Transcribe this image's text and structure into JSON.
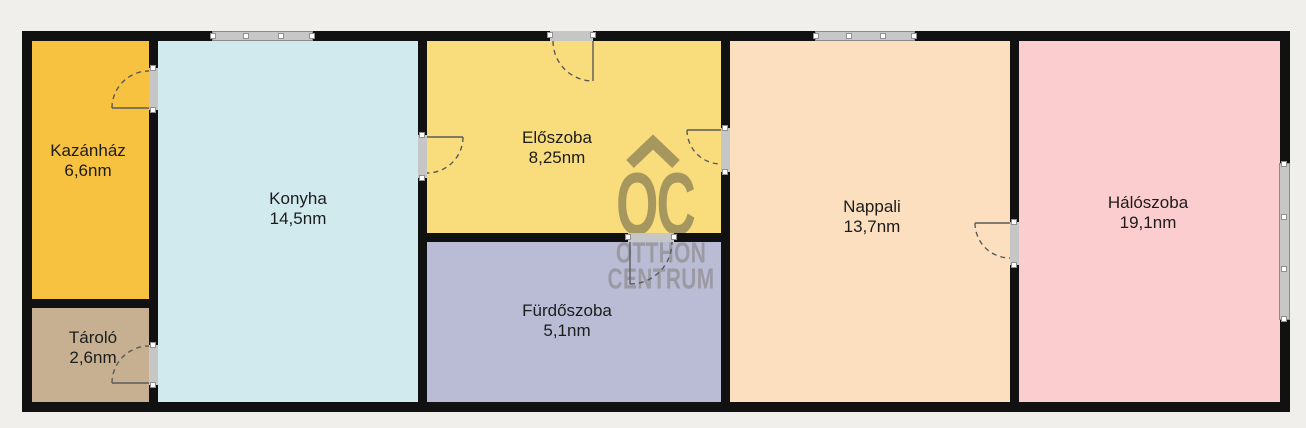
{
  "watermark": {
    "letters": "OC",
    "line1": "OTTHON",
    "line2": "CENTRUM"
  },
  "rooms": [
    {
      "id": "kazanhaz",
      "name": "Kazánház",
      "area": "6,6nm",
      "color": "#F7C23F"
    },
    {
      "id": "tarolo",
      "name": "Tároló",
      "area": "2,6nm",
      "color": "#C6B091"
    },
    {
      "id": "konyha",
      "name": "Konyha",
      "area": "14,5nm",
      "color": "#D1EAEE"
    },
    {
      "id": "eloszoba",
      "name": "Előszoba",
      "area": "8,25nm",
      "color": "#F9DD7D"
    },
    {
      "id": "furdoszoba",
      "name": "Fürdőszoba",
      "area": "5,1nm",
      "color": "#BABCD5"
    },
    {
      "id": "nappali",
      "name": "Nappali",
      "area": "13,7nm",
      "color": "#FCDFBE"
    },
    {
      "id": "haloszoba",
      "name": "Hálószoba",
      "area": "19,1nm",
      "color": "#FCCDCE"
    }
  ],
  "colors": {
    "background": "#F0EFEB",
    "wall": "#111111",
    "window_fill": "#C7C7C7",
    "door_jamb": "#C6C6C6",
    "door_swing": "#5A5A5A",
    "label_text": "#1C1C1C",
    "watermark_gold": "#A6975E",
    "watermark_gray": "#9B99A2"
  }
}
